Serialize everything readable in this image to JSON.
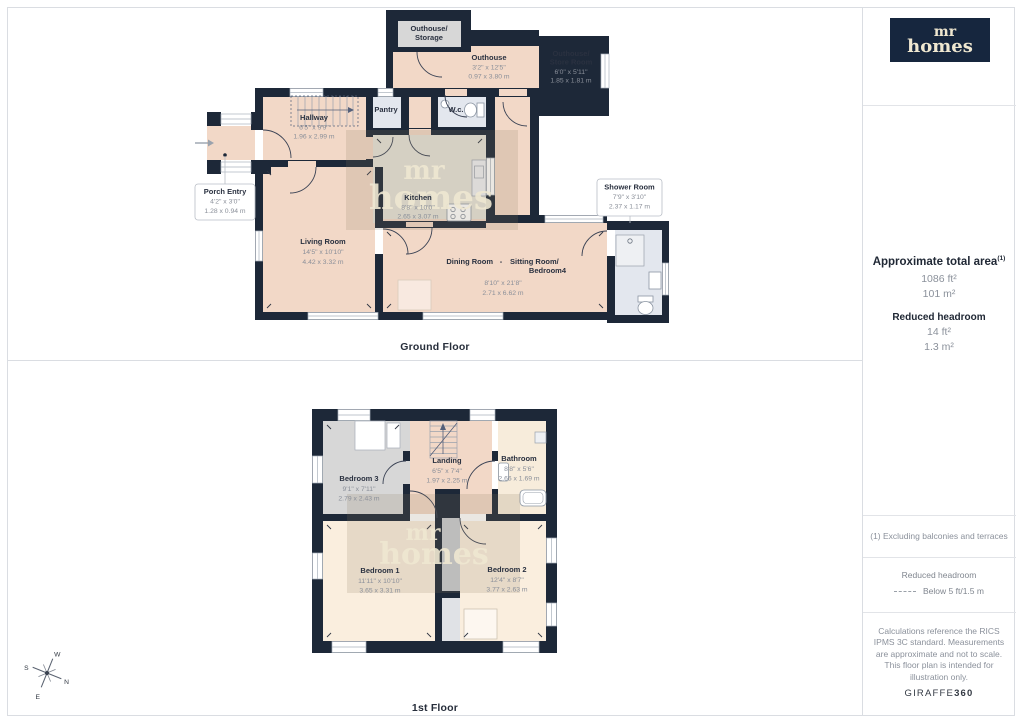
{
  "colors": {
    "wall": "#1d2838",
    "floor_peach": "#f2d8c7",
    "floor_cream": "#faeede",
    "floor_gray": "#d7d7d7",
    "floor_tile": "#e3e7ee",
    "brand_navy": "#16263e",
    "brand_cream": "#efe7d0"
  },
  "logo": {
    "line1": "mr",
    "line2": "homes"
  },
  "watermark": {
    "line1": "mr",
    "line2": "homes"
  },
  "compass": {
    "n": "N",
    "e": "E",
    "s": "S",
    "w": "W"
  },
  "ground": {
    "label": "Ground Floor",
    "rooms": {
      "outhouse_storage": {
        "name1": "Outhouse/",
        "name2": "Storage"
      },
      "outhouse": {
        "name": "Outhouse",
        "ft": "3'2\" x 12'5\"",
        "m": "0.97 x 3.80 m"
      },
      "outhouse_store": {
        "name1": "Outhouse/",
        "name2": "Store Room",
        "ft": "6'0\" x 5'11\"",
        "m": "1.85 x 1.81 m"
      },
      "hallway": {
        "name": "Hallway",
        "ft": "6'5\" x 9'9\"",
        "m": "1.96 x 2.99 m"
      },
      "pantry": {
        "name": "Pantry"
      },
      "wc": {
        "name": "W.c."
      },
      "porch": {
        "name": "Porch Entry",
        "ft": "4'2\" x 3'0\"",
        "m": "1.28 x 0.94 m"
      },
      "kitchen": {
        "name": "Kitchen",
        "ft": "8'8\" x 10'0\"",
        "m": "2.65 x 3.07 m"
      },
      "living": {
        "name": "Living Room",
        "ft": "14'5\" x 10'10\"",
        "m": "4.42 x 3.32 m"
      },
      "dining": {
        "name_a": "Dining Room",
        "dash": "-",
        "name_b": "Sitting Room/",
        "name_c": "Bedroom4",
        "ft": "8'10\" x 21'8\"",
        "m": "2.71 x 6.62 m"
      },
      "shower": {
        "name": "Shower Room",
        "ft": "7'9\" x 3'10\"",
        "m": "2.37 x 1.17 m"
      }
    }
  },
  "first": {
    "label": "1st Floor",
    "rooms": {
      "bedroom3": {
        "name": "Bedroom 3",
        "ft": "9'1\" x 7'11\"",
        "m": "2.79 x 2.43 m"
      },
      "landing": {
        "name": "Landing",
        "ft": "6'5\" x 7'4\"",
        "m": "1.97 x 2.25 m"
      },
      "bathroom": {
        "name": "Bathroom",
        "ft": "8'8\" x 5'6\"",
        "m": "2.66 x 1.69 m"
      },
      "bedroom1": {
        "name": "Bedroom 1",
        "ft": "11'11\" x 10'10\"",
        "m": "3.65 x 3.31 m"
      },
      "bedroom2": {
        "name": "Bedroom 2",
        "ft": "12'4\" x 8'7\"",
        "m": "3.77 x 2.63 m"
      }
    }
  },
  "sidebar": {
    "area_title": "Approximate total area",
    "area_sup": "(1)",
    "area_ft": "1086 ft²",
    "area_m": "101 m²",
    "headroom_title": "Reduced headroom",
    "headroom_ft": "14 ft²",
    "headroom_m": "1.3 m²",
    "note1": "(1) Excluding balconies and terraces",
    "legend_title": "Reduced headroom",
    "legend_value": "Below 5 ft/1.5 m",
    "disclaimer": "Calculations reference the RICS IPMS 3C standard. Measurements are approximate and not to scale. This floor plan is intended for illustration only.",
    "brand_footer_regular": "GIRAFFE",
    "brand_footer_bold": "360"
  }
}
